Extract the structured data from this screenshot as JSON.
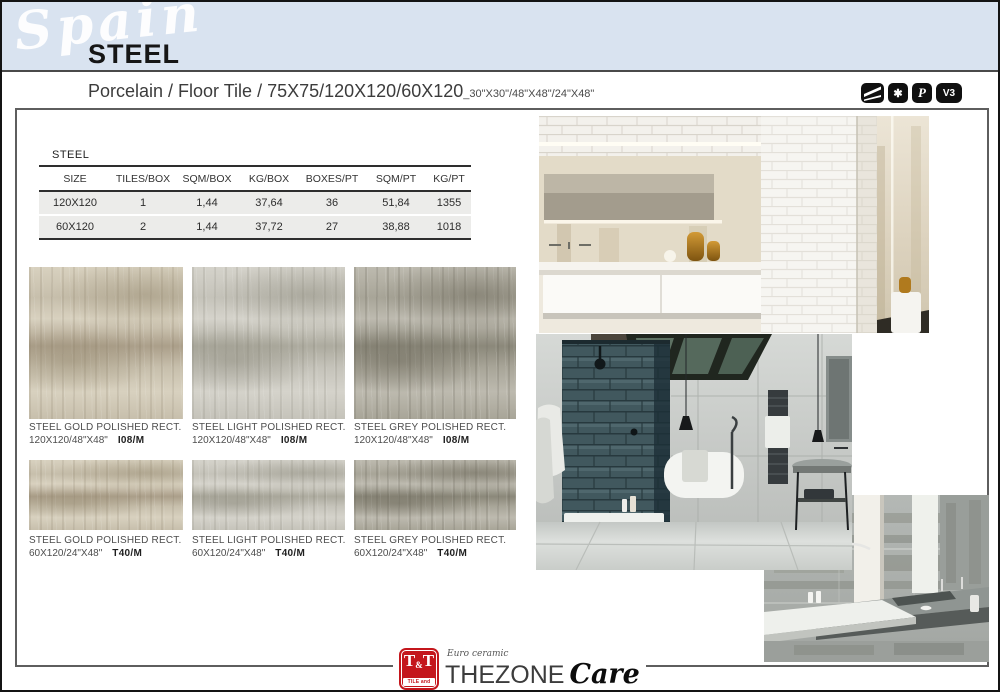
{
  "header": {
    "country": "Spain",
    "collection": "STEEL",
    "subtitle": "Porcelain / Floor Tile / 75X75/120X120/60X120",
    "subtitle_inches": "_30\"X30\"/48\"X48\"/24\"X48\"",
    "band_color": "#d9e3f0"
  },
  "badges": [
    {
      "name": "rectified-edge-icon"
    },
    {
      "name": "star-rating-icon",
      "glyph": "✱"
    },
    {
      "name": "polished-surface-icon",
      "glyph": "P"
    },
    {
      "name": "shade-variation-icon",
      "glyph": "V3"
    }
  ],
  "spec_table": {
    "title": "STEEL",
    "columns": [
      "SIZE",
      "TILES/BOX",
      "SQM/BOX",
      "KG/BOX",
      "BOXES/PT",
      "SQM/PT",
      "KG/PT"
    ],
    "rows": [
      [
        "120X120",
        "1",
        "1,44",
        "37,64",
        "36",
        "51,84",
        "1355"
      ],
      [
        "60X120",
        "2",
        "1,44",
        "37,72",
        "27",
        "38,88",
        "1018"
      ]
    ]
  },
  "products": [
    {
      "name": "STEEL GOLD POLISHED RECT.",
      "size": "120X120/48\"X48\"",
      "code": "I08/M"
    },
    {
      "name": "STEEL LIGHT POLISHED RECT.",
      "size": "120X120/48\"X48\"",
      "code": "I08/M"
    },
    {
      "name": "STEEL GREY POLISHED RECT.",
      "size": "120X120/48\"X48\"",
      "code": "I08/M"
    },
    {
      "name": "STEEL GOLD POLISHED RECT.",
      "size": "60X120/24\"X48\"",
      "code": "T40/M"
    },
    {
      "name": "STEEL LIGHT POLISHED RECT.",
      "size": "60X120/24\"X48\"",
      "code": "T40/M"
    },
    {
      "name": "STEEL GREY POLISHED RECT.",
      "size": "60X120/24\"X48\"",
      "code": "T40/M"
    }
  ],
  "footer": {
    "tt_t1": "T",
    "tt_amp": "&",
    "tt_t2": "T",
    "tt_sub": "TILE and TRADE",
    "tagline": "Euro ceramic",
    "brand": "THEZONE",
    "brand_script": "Care"
  },
  "colors": {
    "logo_red": "#c4161c",
    "band_blue": "#d9e3f0",
    "table_row_bg": "#ececea"
  }
}
